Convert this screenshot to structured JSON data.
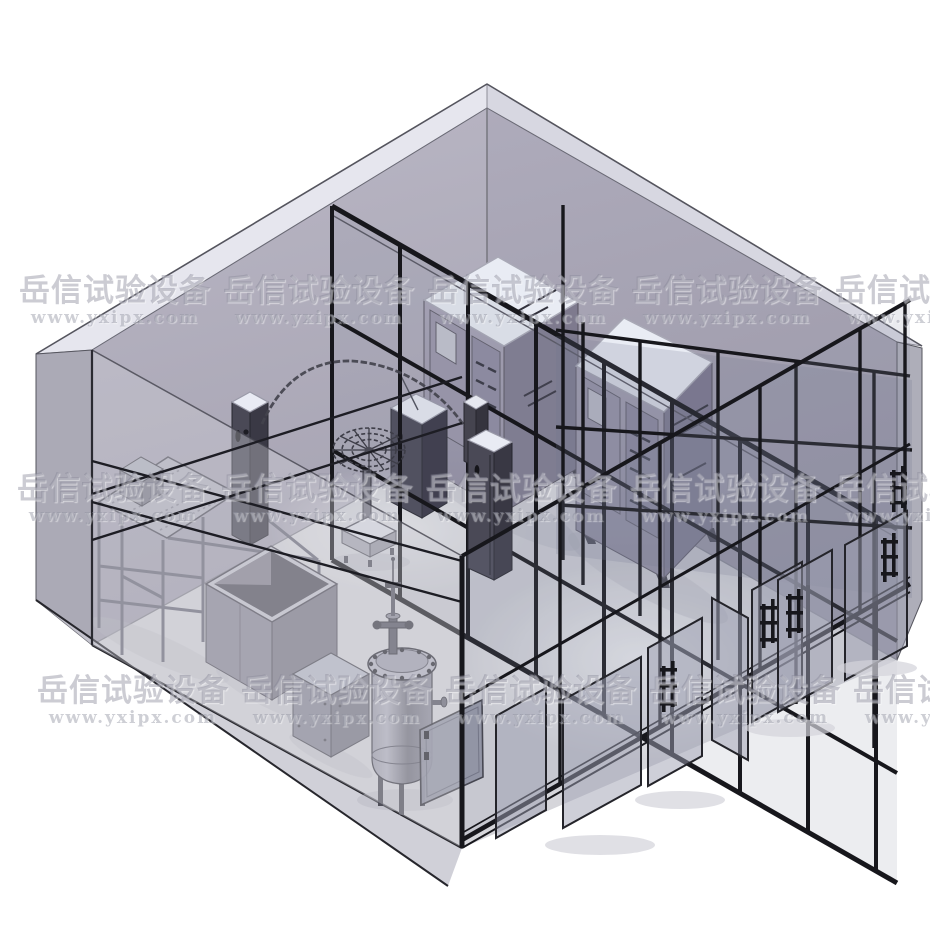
{
  "watermark": {
    "brand_text": "岳信试验设备",
    "url_text": "www.yxipx.com",
    "tile_period_px": 204,
    "rows": [
      {
        "y": 276,
        "start_x": 13,
        "count": 5
      },
      {
        "y": 474,
        "start_x": 11,
        "count": 5
      },
      {
        "y": 676,
        "start_x": 31,
        "count": 5
      }
    ],
    "brand_color": "rgba(128,128,144,0.40)",
    "url_color": "rgba(138,140,156,0.42)"
  },
  "scene": {
    "type": "isometric-cad-render",
    "subject": "Walk-in waterproof test laboratory enclosure (rain spray / immersion test room) shown as translucent 3D CAD model",
    "room": {
      "left_wall_color": "#b0adbb",
      "right_wall_color": "#a39fb0",
      "floor_color": "#d5d5da",
      "roof_band_color": "#e3e3eb",
      "frame_color": "#17171c",
      "glass_tint": "rgba(140,143,165,0.20)"
    },
    "equipment": [
      {
        "name": "drip-test-stand",
        "description": "Frame stand with tilted perforated drip plate and drive box"
      },
      {
        "name": "immersion-tank",
        "description": "Open-top rectangular immersion tank"
      },
      {
        "name": "swing-tube-spray-arc",
        "description": "Semicircular oscillating spray tube"
      },
      {
        "name": "sample-turntable",
        "description": "Rotating spoked sample table on pedestal base"
      },
      {
        "name": "left-pivot-column",
        "description": "Swing-tube support / control column"
      },
      {
        "name": "right-pivot-bracket",
        "description": "Swing-tube end support bracket"
      },
      {
        "name": "control-column",
        "description": "Tall control cabinet column"
      },
      {
        "name": "test-chamber-1",
        "description": "Environmental test chamber with front control panel"
      },
      {
        "name": "test-chamber-2",
        "description": "Environmental test chamber with front control panel"
      },
      {
        "name": "small-control-cabinet",
        "description": "Floor-standing control cabinet"
      },
      {
        "name": "pressure-immersion-tank",
        "description": "Cylindrical pressure vessel with bolted flange lid and top valves"
      },
      {
        "name": "spare-door-panel",
        "description": "Door panel leaning on the floor"
      },
      {
        "name": "sliding-glass-doors",
        "description": "Black-framed glass sliding doors with vertical bar handles"
      }
    ]
  }
}
